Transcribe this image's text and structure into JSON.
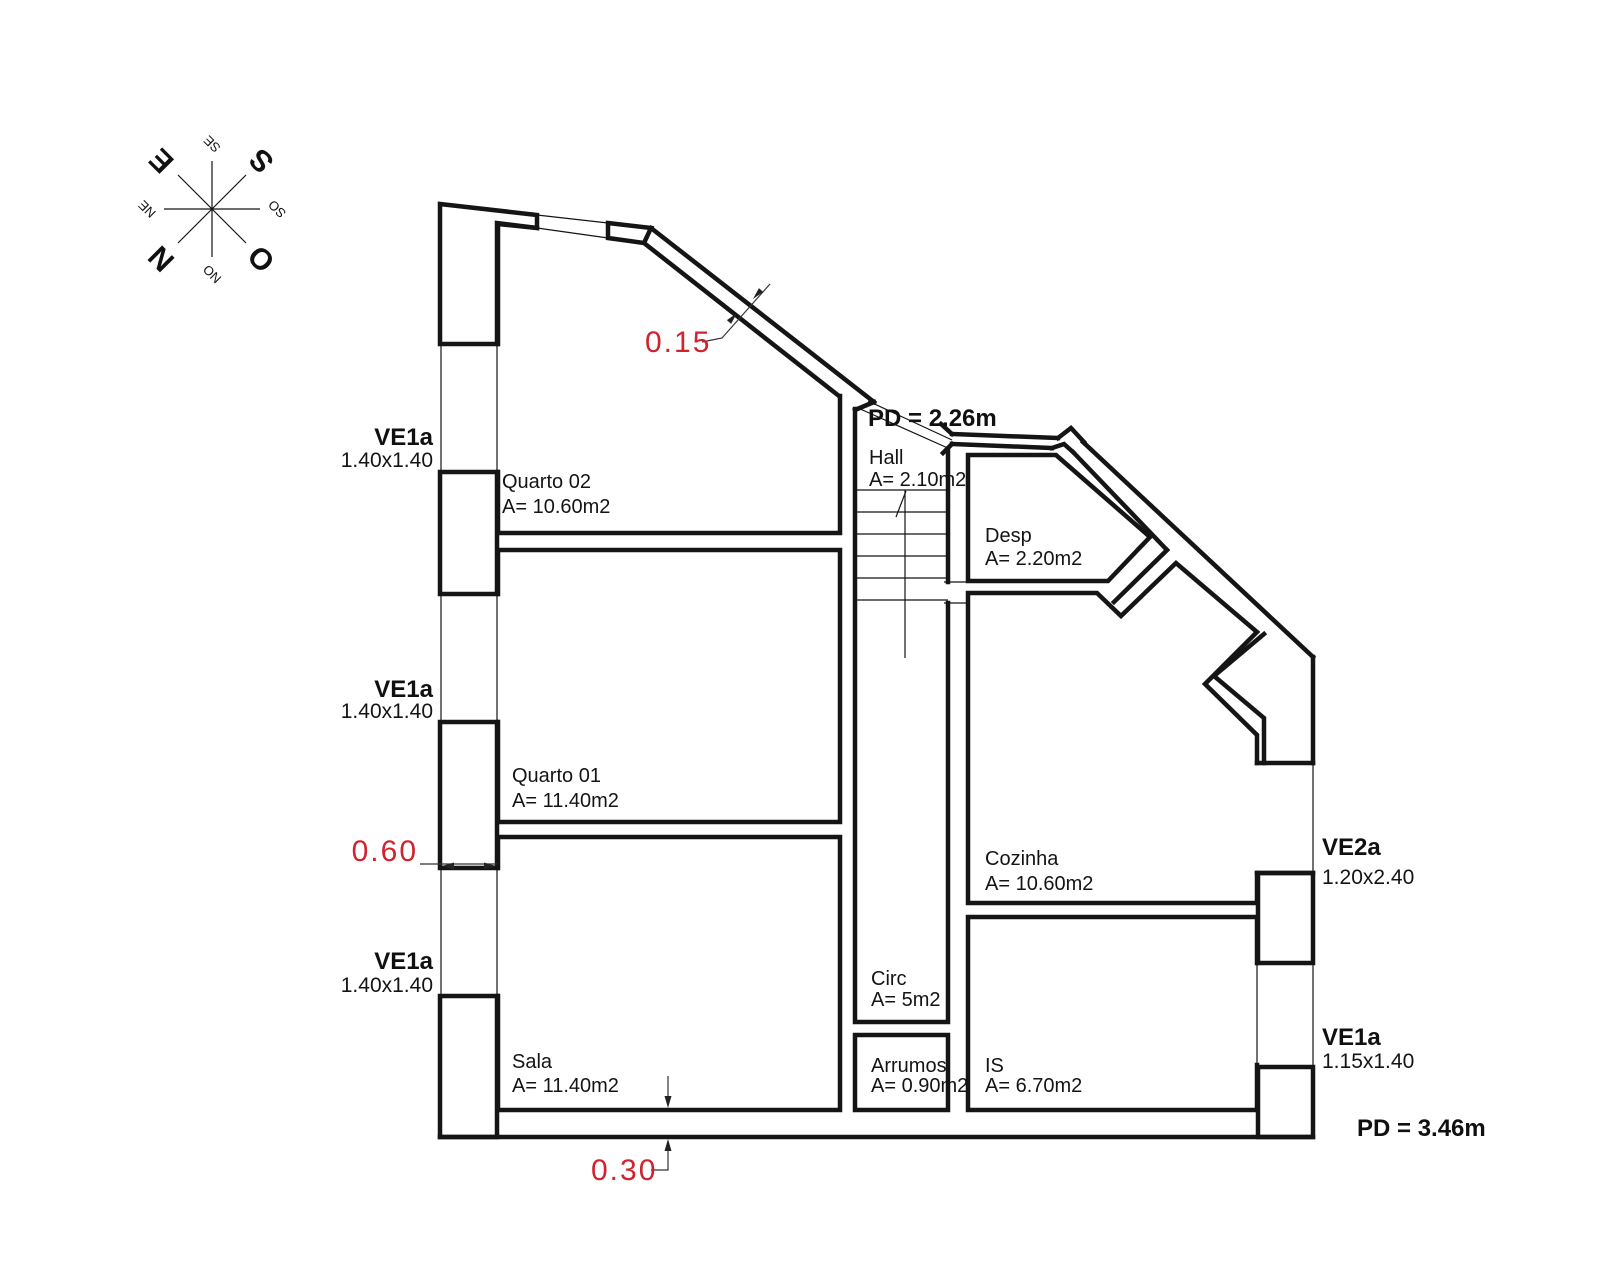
{
  "title": "floor-plan",
  "colors": {
    "line": "#151515",
    "dimension_red": "#cf232f"
  },
  "compass": {
    "points": [
      {
        "label": "N"
      },
      {
        "label": "S"
      },
      {
        "label": "E"
      },
      {
        "label": "O"
      },
      {
        "label": "NE"
      },
      {
        "label": "SE"
      },
      {
        "label": "SO"
      },
      {
        "label": "NO"
      }
    ]
  },
  "rooms": [
    {
      "name": "Quarto 02",
      "area": "A= 10.60m2"
    },
    {
      "name": "Quarto 01",
      "area": "A= 11.40m2"
    },
    {
      "name": "Sala",
      "area": "A= 11.40m2"
    },
    {
      "name": "Hall",
      "area": "A= 2.10m2"
    },
    {
      "name": "Circ",
      "area": "A= 5m2"
    },
    {
      "name": "Arrumos",
      "area": "A= 0.90m2"
    },
    {
      "name": "IS",
      "area": "A= 6.70m2"
    },
    {
      "name": "Desp",
      "area": "A= 2.20m2"
    },
    {
      "name": "Cozinha",
      "area": "A= 10.60m2"
    }
  ],
  "windows": [
    {
      "code": "VE1a",
      "size": "1.40x1.40"
    },
    {
      "code": "VE1a",
      "size": "1.40x1.40"
    },
    {
      "code": "VE1a",
      "size": "1.40x1.40"
    },
    {
      "code": "VE2a",
      "size": "1.20x2.40"
    },
    {
      "code": "VE1a",
      "size": "1.15x1.40"
    }
  ],
  "ceiling_heights": [
    {
      "label": "PD = 2.26m"
    },
    {
      "label": "PD = 3.46m"
    }
  ],
  "dimensions": [
    {
      "value": "0.15"
    },
    {
      "value": "0.60"
    },
    {
      "value": "0.30"
    }
  ]
}
